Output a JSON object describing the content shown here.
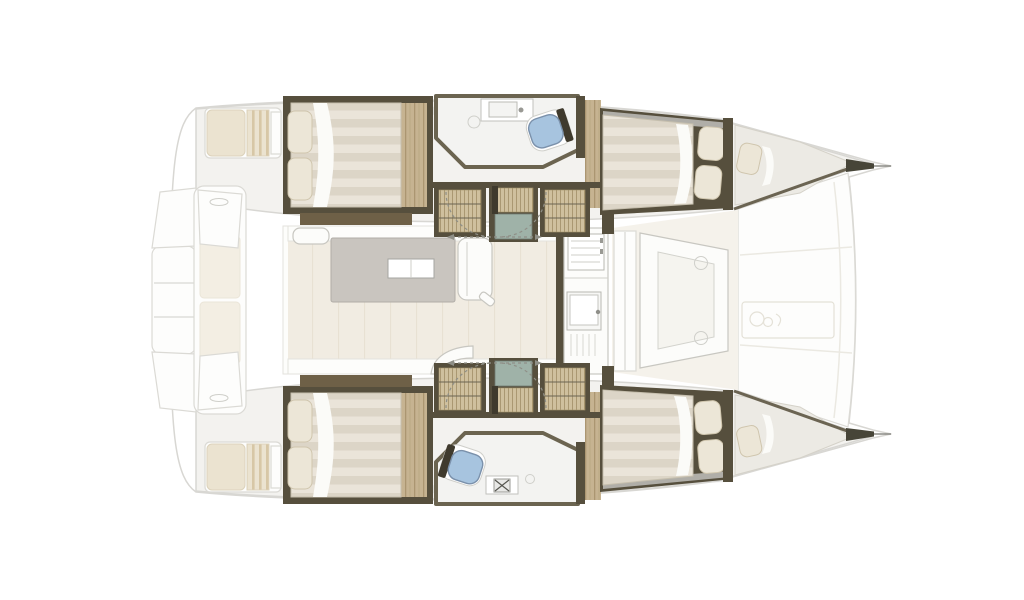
{
  "plan": {
    "type": "catamaran-interior-floorplan",
    "orientation": "bow-right",
    "regions": [
      {
        "name": "aft-cockpit"
      },
      {
        "name": "saloon"
      },
      {
        "name": "galley"
      },
      {
        "name": "forward-cockpit"
      },
      {
        "name": "foredeck"
      },
      {
        "name": "port-hull-aft-cabin"
      },
      {
        "name": "port-hull-head"
      },
      {
        "name": "port-hull-forward-cabin"
      },
      {
        "name": "port-hull-bow-berth"
      },
      {
        "name": "starboard-hull-aft-cabin"
      },
      {
        "name": "starboard-hull-head"
      },
      {
        "name": "starboard-hull-forward-cabin"
      },
      {
        "name": "starboard-hull-bow-berth"
      }
    ],
    "fixtures": [
      {
        "name": "double-bed",
        "count": 4
      },
      {
        "name": "bow-berth",
        "count": 2
      },
      {
        "name": "toilet",
        "count": 2
      },
      {
        "name": "bathroom-sink",
        "count": 2
      },
      {
        "name": "galley-stove",
        "count": 1
      },
      {
        "name": "galley-sink",
        "count": 1
      },
      {
        "name": "saloon-table",
        "count": 1
      },
      {
        "name": "companionway-steps",
        "count": 2
      },
      {
        "name": "door-swing-arc",
        "count": 4
      }
    ]
  },
  "palette": {
    "wall": "#564f3d",
    "wall_dark": "#3f3a2d",
    "wood": "#c6b391",
    "wood_line": "#ab9671",
    "slat": "#cfc09e",
    "slat_line": "#a6946d",
    "base_brown": "#6e6047",
    "duvet_a": "#dcd5c7",
    "duvet_b": "#eae4d9",
    "duvet_edge": "#c6bfae",
    "pillow": "#ece6d7",
    "pillow_edge": "#cfc5ad",
    "sheet": "#fbfbf8",
    "head_floor": "#f3f3f1",
    "head_border": "#6b6450",
    "toilet_blue": "#a7c4df",
    "toilet_edge": "#7b91ab",
    "teal": "#9fb2a8",
    "saloon_floor": "#f1ece2",
    "floor_line": "#e4dccd",
    "band_white": "#fdfdfb",
    "table_gray": "#c9c5bf",
    "table_edge": "#b1ada7",
    "white_furn": "#fcfcfa",
    "furn_edge": "#c8c7c1",
    "faint_edge": "#dbdad5",
    "hull_band": "#f3f2ef",
    "silver": "#d7d7d5",
    "cushion": "#ebe3d0",
    "cushion_edge": "#dcd2bb",
    "cushion_stripe": "#d7c7a6",
    "arc_line": "#8f8f87",
    "fwd_floor": "#f5f2eb",
    "outline": "#d8d7d3",
    "tip_dark": "#474538",
    "emblem_edge": "#e4e1d7",
    "background": "#ffffff"
  }
}
